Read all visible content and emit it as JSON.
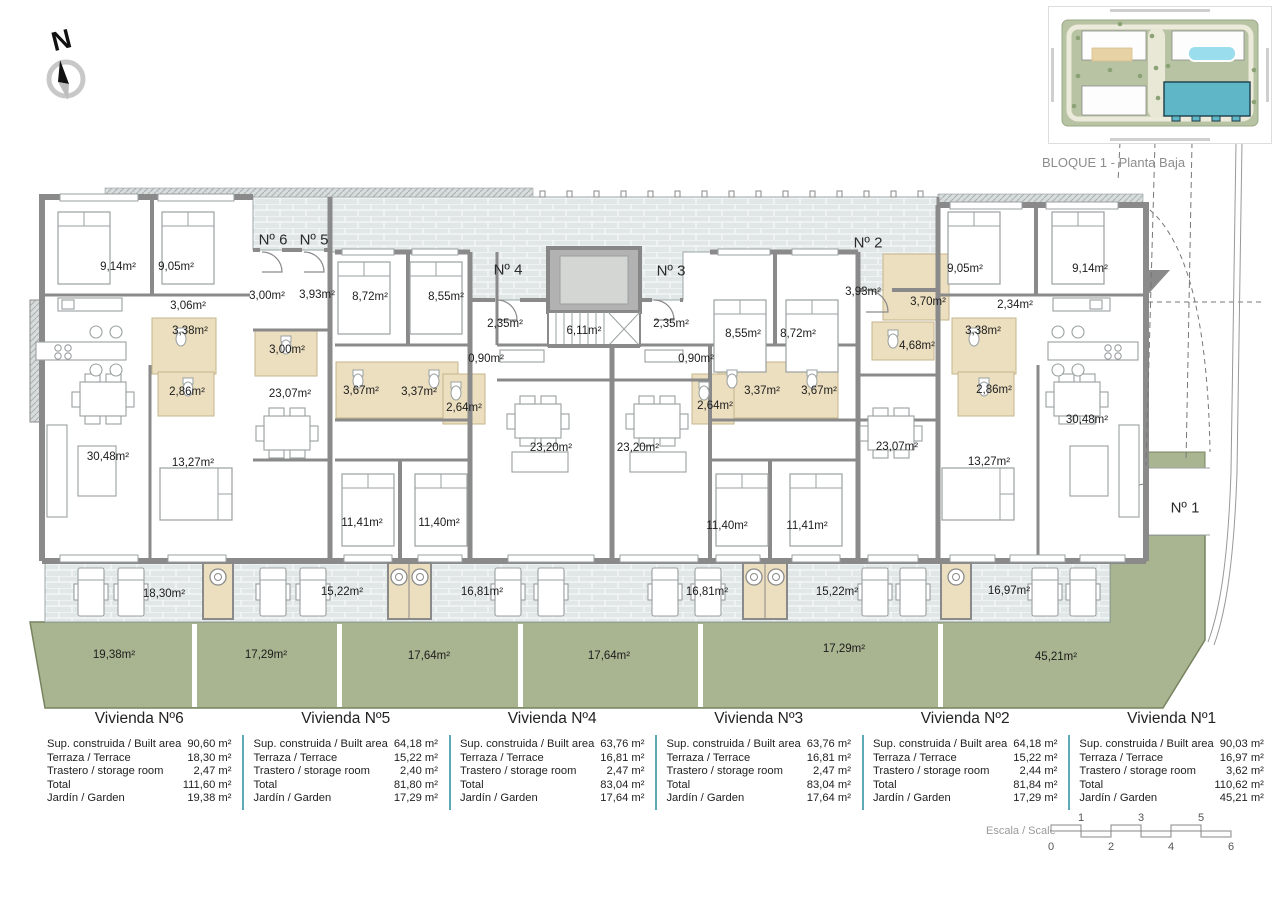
{
  "compass": {
    "label": "N"
  },
  "site_plan": {
    "caption": "BLOQUE 1 - Planta Baja",
    "icon": "site-plan-thumbnail"
  },
  "colors": {
    "wall": "#8a8a8a",
    "paving": "#e1e7e7",
    "garden": "#a9b490",
    "bath": "#ecdfbf",
    "table_separator": "#5fa9b5",
    "highlight_building": "#5fb6c6"
  },
  "plan": {
    "entrance_labels": [
      {
        "text": "Nº 6",
        "x": 273,
        "y": 240
      },
      {
        "text": "Nº 5",
        "x": 314,
        "y": 240
      },
      {
        "text": "Nº 4",
        "x": 508,
        "y": 270
      },
      {
        "text": "Nº 3",
        "x": 671,
        "y": 271
      },
      {
        "text": "Nº 2",
        "x": 868,
        "y": 243
      },
      {
        "text": "Nº 1",
        "x": 1185,
        "y": 508
      }
    ],
    "room_labels": [
      {
        "text": "9,14m²",
        "x": 118,
        "y": 267
      },
      {
        "text": "9,05m²",
        "x": 176,
        "y": 267
      },
      {
        "text": "3,06m²",
        "x": 188,
        "y": 306
      },
      {
        "text": "3,38m²",
        "x": 190,
        "y": 331
      },
      {
        "text": "2,86m²",
        "x": 187,
        "y": 392
      },
      {
        "text": "30,48m²",
        "x": 108,
        "y": 457
      },
      {
        "text": "13,27m²",
        "x": 193,
        "y": 463
      },
      {
        "text": "23,07m²",
        "x": 290,
        "y": 394
      },
      {
        "text": "3,00m²",
        "x": 267,
        "y": 296
      },
      {
        "text": "3,93m²",
        "x": 317,
        "y": 295
      },
      {
        "text": "3,00m²",
        "x": 287,
        "y": 350
      },
      {
        "text": "8,72m²",
        "x": 370,
        "y": 297
      },
      {
        "text": "8,55m²",
        "x": 446,
        "y": 297
      },
      {
        "text": "3,67m²",
        "x": 361,
        "y": 391
      },
      {
        "text": "3,37m²",
        "x": 419,
        "y": 392
      },
      {
        "text": "2,64m²",
        "x": 464,
        "y": 408
      },
      {
        "text": "11,41m²",
        "x": 362,
        "y": 523
      },
      {
        "text": "11,40m²",
        "x": 439,
        "y": 523
      },
      {
        "text": "2,35m²",
        "x": 505,
        "y": 324
      },
      {
        "text": "0,90m²",
        "x": 486,
        "y": 359
      },
      {
        "text": "6,11m²",
        "x": 584,
        "y": 331
      },
      {
        "text": "23,20m²",
        "x": 551,
        "y": 448
      },
      {
        "text": "23,20m²",
        "x": 638,
        "y": 448
      },
      {
        "text": "2,35m²",
        "x": 671,
        "y": 324
      },
      {
        "text": "0,90m²",
        "x": 696,
        "y": 359
      },
      {
        "text": "2,64m²",
        "x": 715,
        "y": 406
      },
      {
        "text": "3,37m²",
        "x": 762,
        "y": 391
      },
      {
        "text": "3,67m²",
        "x": 819,
        "y": 391
      },
      {
        "text": "8,55m²",
        "x": 743,
        "y": 334
      },
      {
        "text": "8,72m²",
        "x": 798,
        "y": 334
      },
      {
        "text": "11,40m²",
        "x": 727,
        "y": 526
      },
      {
        "text": "11,41m²",
        "x": 807,
        "y": 526
      },
      {
        "text": "3,93m²",
        "x": 863,
        "y": 292
      },
      {
        "text": "3,70m²",
        "x": 928,
        "y": 302
      },
      {
        "text": "4,68m²",
        "x": 917,
        "y": 346
      },
      {
        "text": "23,07m²",
        "x": 897,
        "y": 447
      },
      {
        "text": "13,27m²",
        "x": 989,
        "y": 462
      },
      {
        "text": "3,38m²",
        "x": 983,
        "y": 331
      },
      {
        "text": "2,86m²",
        "x": 994,
        "y": 390
      },
      {
        "text": "2,34m²",
        "x": 1015,
        "y": 305
      },
      {
        "text": "9,05m²",
        "x": 965,
        "y": 269
      },
      {
        "text": "9,14m²",
        "x": 1090,
        "y": 269
      },
      {
        "text": "30,48m²",
        "x": 1087,
        "y": 420
      },
      {
        "text": "18,30m²",
        "x": 164,
        "y": 594
      },
      {
        "text": "15,22m²",
        "x": 342,
        "y": 592
      },
      {
        "text": "16,81m²",
        "x": 482,
        "y": 592
      },
      {
        "text": "16,81m²",
        "x": 707,
        "y": 592
      },
      {
        "text": "15,22m²",
        "x": 837,
        "y": 592
      },
      {
        "text": "16,97m²",
        "x": 1009,
        "y": 591
      },
      {
        "text": "19,38m²",
        "x": 114,
        "y": 655
      },
      {
        "text": "17,29m²",
        "x": 266,
        "y": 655
      },
      {
        "text": "17,64m²",
        "x": 429,
        "y": 656
      },
      {
        "text": "17,64m²",
        "x": 609,
        "y": 656
      },
      {
        "text": "17,29m²",
        "x": 844,
        "y": 649
      },
      {
        "text": "45,21m²",
        "x": 1056,
        "y": 657
      }
    ]
  },
  "table_row_labels": [
    "Sup. construida / Built area",
    "Terraza / Terrace",
    "Trastero / storage room",
    "Total",
    "Jardín / Garden"
  ],
  "units": [
    {
      "title": "Vivienda Nº6",
      "values": [
        "90,60 m²",
        "18,30 m²",
        "2,47 m²",
        "111,60 m²",
        "19,38 m²"
      ]
    },
    {
      "title": "Vivienda Nº5",
      "values": [
        "64,18 m²",
        "15,22 m²",
        "2,40 m²",
        "81,80 m²",
        "17,29 m²"
      ]
    },
    {
      "title": "Vivienda Nº4",
      "values": [
        "63,76 m²",
        "16,81 m²",
        "2,47 m²",
        "83,04 m²",
        "17,64 m²"
      ]
    },
    {
      "title": "Vivienda Nº3",
      "values": [
        "63,76 m²",
        "16,81 m²",
        "2,47 m²",
        "83,04 m²",
        "17,64 m²"
      ]
    },
    {
      "title": "Vivienda Nº2",
      "values": [
        "64,18 m²",
        "15,22 m²",
        "2,44 m²",
        "81,84 m²",
        "17,29 m²"
      ]
    },
    {
      "title": "Vivienda Nº1",
      "values": [
        "90,03 m²",
        "16,97 m²",
        "3,62 m²",
        "110,62 m²",
        "45,21 m²"
      ]
    }
  ],
  "scale": {
    "label": "Escala / Scale",
    "top_ticks": [
      "1",
      "3",
      "5"
    ],
    "bottom_ticks": [
      "0",
      "2",
      "4",
      "6"
    ]
  }
}
